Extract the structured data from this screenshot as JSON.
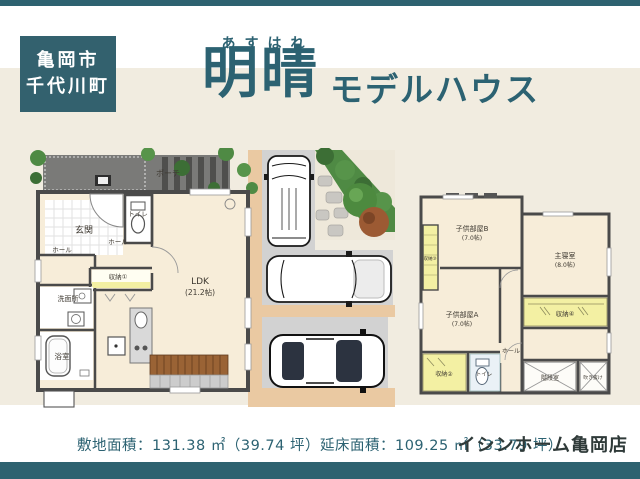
{
  "colors": {
    "accent_teal": "#2e6270",
    "badge_teal": "#33616e",
    "title_teal": "#2c6272",
    "cream_background": "#f1ece0",
    "room_beige": "#f7edd9",
    "storage_yellow": "#f3f0a3",
    "wall_gray": "#4a4a4a",
    "driveway_gray": "#d2d2d2",
    "path_tan": "#eac9a2"
  },
  "header": {
    "location_line1": "亀岡市",
    "location_line2": "千代川町",
    "furigana": "あすはれ",
    "title": "明晴",
    "subtitle": "モデルハウス"
  },
  "plan1f": {
    "rooms": [
      {
        "id": "porch",
        "label": "ポーチ"
      },
      {
        "id": "entrance",
        "label": "玄関"
      },
      {
        "id": "toilet",
        "label": "トイレ"
      },
      {
        "id": "hall-1",
        "label": "ホール"
      },
      {
        "id": "hall-2",
        "label": "ホール"
      },
      {
        "id": "storage-1",
        "label": "収納①"
      },
      {
        "id": "ldk",
        "label": "LDK",
        "size": "(21.2帖)"
      },
      {
        "id": "washroom",
        "label": "洗面所"
      },
      {
        "id": "bath",
        "label": "浴室"
      }
    ],
    "illustrations": [
      "van-top-view",
      "suv-top-view",
      "car-top-view",
      "garden-trees",
      "stepping-stones",
      "staircase",
      "kitchen-counter"
    ]
  },
  "plan2f": {
    "rooms": [
      {
        "id": "kids-room-b",
        "label": "子供部屋B",
        "size": "(7.0帖)"
      },
      {
        "id": "master-bedroom",
        "label": "主寝室",
        "size": "(8.0帖)"
      },
      {
        "id": "storage-3",
        "label": "収納③"
      },
      {
        "id": "kids-room-a",
        "label": "子供部屋A",
        "size": "(7.0帖)"
      },
      {
        "id": "storage-2",
        "label": "収納②"
      },
      {
        "id": "toilet",
        "label": "トイレ"
      },
      {
        "id": "hall",
        "label": "ホール"
      },
      {
        "id": "storage-4",
        "label": "収納④"
      },
      {
        "id": "stairwell",
        "label": "階段室"
      },
      {
        "id": "void",
        "label": "吹き抜け"
      }
    ]
  },
  "footer": {
    "area_text": "敷地面積：131.38 ㎡（39.74 坪）延床面積：109.25 ㎡（33.79 坪）",
    "site_area_sqm": "131.38",
    "site_area_tsubo": "39.74",
    "floor_area_sqm": "109.25",
    "floor_area_tsubo": "33.79",
    "store_name": "イシンホーム亀岡店"
  }
}
